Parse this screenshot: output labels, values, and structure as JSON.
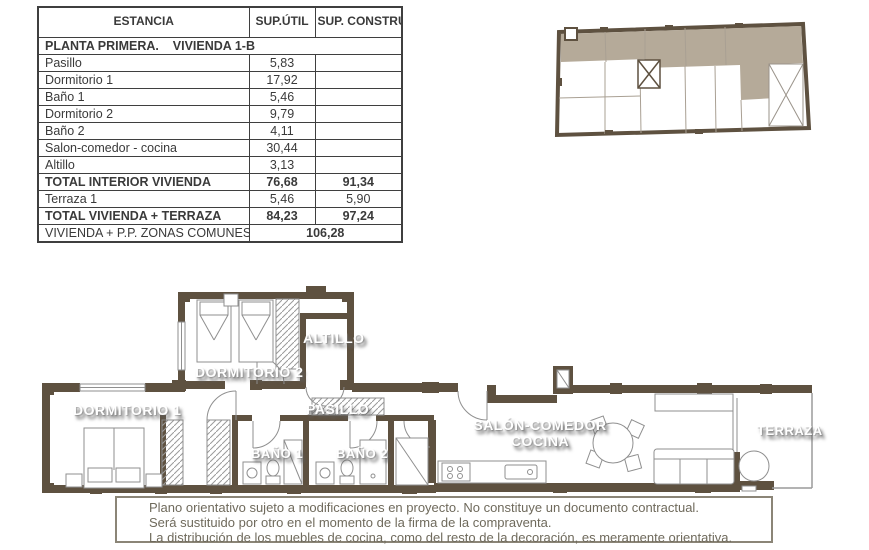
{
  "colors": {
    "wall": "#5e5140",
    "keyplan_highlight": "#b5aa99",
    "table_border": "#3f3f3f",
    "disclaimer_text": "#6f6a5c"
  },
  "table": {
    "headers": [
      "ESTANCIA",
      "SUP.ÚTIL",
      "SUP. CONSTRUIDA"
    ],
    "section_title": "PLANTA PRIMERA.    VIVIENDA 1-B",
    "rows": [
      {
        "name": "Pasillo",
        "util": "5,83",
        "built": ""
      },
      {
        "name": "Dormitorio 1",
        "util": "17,92",
        "built": ""
      },
      {
        "name": "Baño 1",
        "util": "5,46",
        "built": ""
      },
      {
        "name": "Dormitorio 2",
        "util": "9,79",
        "built": ""
      },
      {
        "name": "Baño 2",
        "util": "4,11",
        "built": ""
      },
      {
        "name": "Salon-comedor - cocina",
        "util": "30,44",
        "built": ""
      },
      {
        "name": "Altillo",
        "util": "3,13",
        "built": ""
      },
      {
        "name": "TOTAL INTERIOR VIVIENDA",
        "util": "76,68",
        "built": "91,34"
      },
      {
        "name": "Terraza 1",
        "util": "5,46",
        "built": "5,90"
      },
      {
        "name": "TOTAL VIVIENDA + TERRAZA",
        "util": "84,23",
        "built": "97,24"
      }
    ],
    "footer": {
      "name": "VIVIENDA + P.P. ZONAS COMUNES",
      "value": "106,28"
    }
  },
  "plan": {
    "labels": {
      "dormitorio1": "DORMITORIO 1",
      "dormitorio2": "DORMITORIO 2",
      "altillo": "ALTILLO",
      "pasillo": "PASILLO",
      "bano1": "BAÑO 1",
      "bano2": "BAÑO 2",
      "salon_line1": "SALÓN-COMEDOR",
      "salon_line2": "COCINA",
      "terraza": "TERRAZA"
    }
  },
  "disclaimer": {
    "lines": [
      "Plano orientativo sujeto a modificaciones en proyecto. No constituye un documento contractual.",
      "Será sustituido por otro en el momento de la firma de la compraventa.",
      "La distribución de los muebles de cocina, como del resto de la decoración, es meramente orientativa."
    ]
  }
}
